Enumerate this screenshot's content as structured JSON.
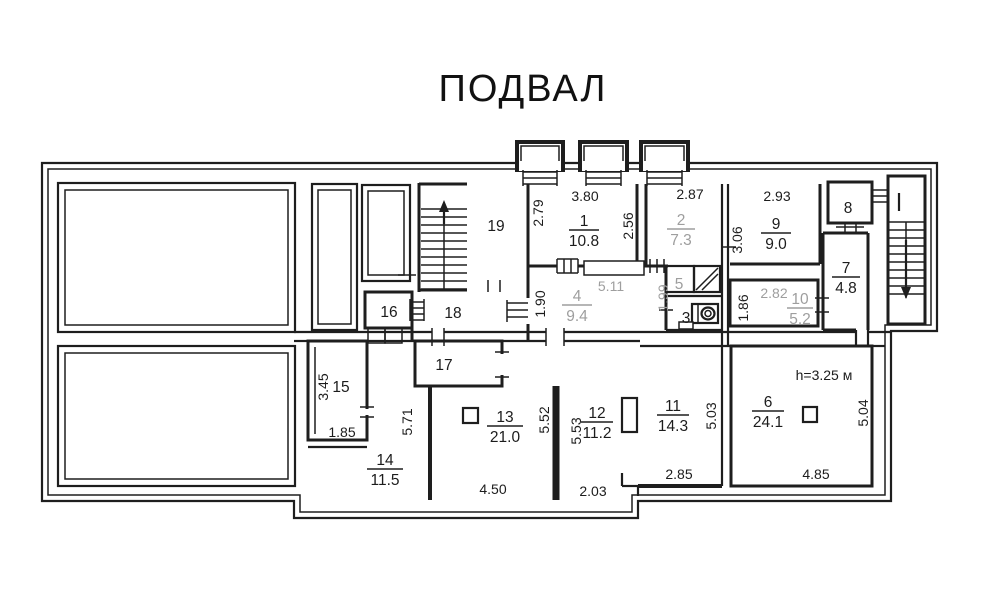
{
  "title": "ПОДВАЛ",
  "height_note": "h=3.25 м",
  "rooms": {
    "r1": {
      "number": "1",
      "area": "10.8"
    },
    "r2": {
      "number": "2",
      "area": "7.3"
    },
    "r3": {
      "number": "3"
    },
    "r4": {
      "number": "4",
      "area": "9.4"
    },
    "r5": {
      "number": "5"
    },
    "r6": {
      "number": "6",
      "area": "24.1"
    },
    "r7": {
      "number": "7",
      "area": "4.8"
    },
    "r8": {
      "number": "8"
    },
    "r9": {
      "number": "9",
      "area": "9.0"
    },
    "r10": {
      "number": "10",
      "area": "5.2"
    },
    "r11": {
      "number": "11",
      "area": "14.3"
    },
    "r12": {
      "number": "12",
      "area": "11.2"
    },
    "r13": {
      "number": "13",
      "area": "21.0"
    },
    "r14": {
      "number": "14",
      "area": "11.5"
    },
    "r15": {
      "number": "15"
    },
    "r16": {
      "number": "16"
    },
    "r17": {
      "number": "17"
    },
    "r18": {
      "number": "18"
    },
    "r19": {
      "number": "19"
    }
  },
  "dims": {
    "w1_top": "3.80",
    "w1_left": "2.79",
    "w1_right": "2.56",
    "w2_top": "2.87",
    "w9_top": "2.93",
    "w9_left": "3.06",
    "c4_left": "1.90",
    "c4_top": "5.11",
    "c4_right": "1.99",
    "w10_top": "2.82",
    "w10_left": "1.86",
    "w15_left": "3.45",
    "w15_bottom": "1.85",
    "corridor": "5.71",
    "w13_right": "5.52",
    "w13_bottom": "4.50",
    "w12_left": "5.53",
    "w12_bottom": "2.03",
    "w11_right": "5.03",
    "w11_bottom": "2.85",
    "w6_right": "5.04",
    "w6_bottom": "4.85"
  },
  "colors": {
    "wall": "#1e1e1e",
    "muted_text": "#9e9e9e"
  }
}
